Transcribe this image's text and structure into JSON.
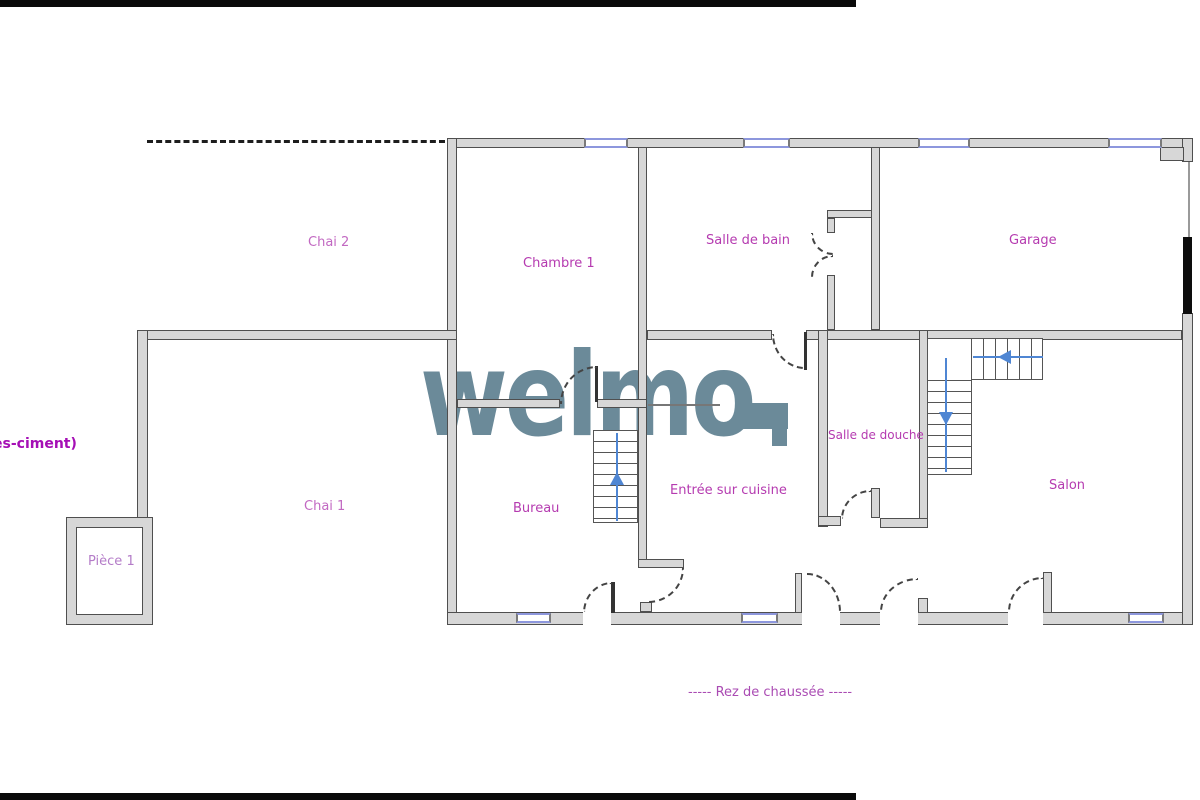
{
  "plan": {
    "floor_label": "-----  Rez de chaussée  -----",
    "watermark": "welmo",
    "left_edge_text": "es-ciment)",
    "rooms": {
      "chai2": "Chai 2",
      "chambre1": "Chambre 1",
      "salle_de_bain": "Salle de bain",
      "garage": "Garage",
      "chai1": "Chai 1",
      "piece1": "Pièce 1",
      "bureau": "Bureau",
      "entree": "Entrée sur cuisine",
      "salle_de_douche": "Salle de douche",
      "salon": "Salon"
    },
    "colors": {
      "label_purple": "#b53bb0",
      "watermark_slate": "#6b8a99",
      "wall_fill": "#d7d7d7",
      "wall_edge": "#4f4f4f",
      "window_blue": "#8d97dd",
      "stair_arrow_blue": "#4f86d3",
      "garage_door_black": "#0a0a0a"
    }
  }
}
